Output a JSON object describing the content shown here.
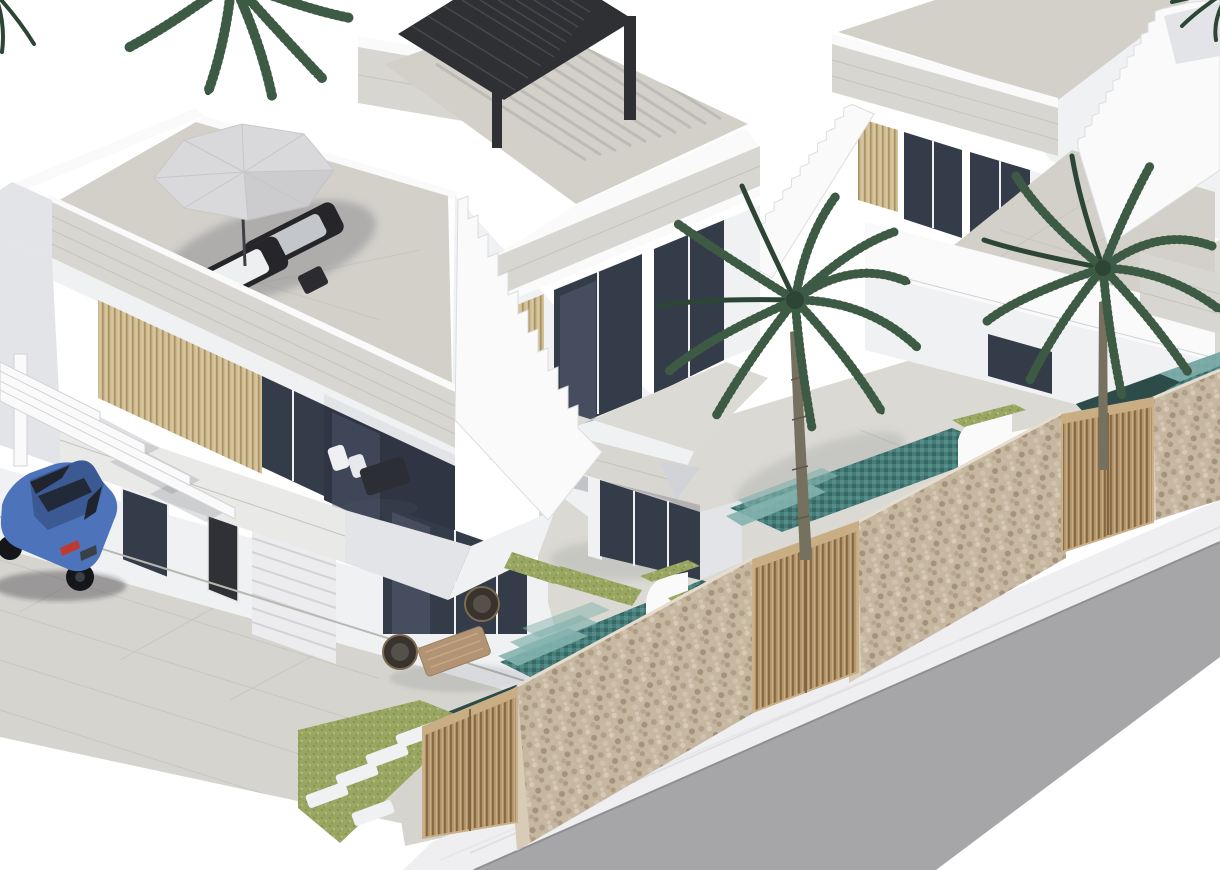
{
  "meta": {
    "type": "3d-architectural-render",
    "subject": "Isometric CGI rendering of a row of three modern white two-storey villas with roof terraces, private pools, palm trees, stone boundary walls with wooden gates, a parked blue car under a carport, and a street with sidewalk in the foreground",
    "canvas": {
      "width": 1220,
      "height": 870
    }
  },
  "colors": {
    "bg": "#ffffff",
    "w0": "#fafafb",
    "w1": "#f0f1f3",
    "w2": "#e3e4e8",
    "w3": "#d2d3d8",
    "w4": "#c2c3c9",
    "trav": "#d8d6d0",
    "travd": "#c6c4bd",
    "floor": "#d2d0c9",
    "floor2": "#dcdad4",
    "terr": "#dbd9d3",
    "drive": "#d6d4ce",
    "joint": "#c2c0ba",
    "glass": "#353c49",
    "glassm": "#58627a",
    "frame": "#eef0f2",
    "slata": "#cdbb94",
    "slatb": "#a18854",
    "gatea": "#b2946c",
    "gateb": "#86683f",
    "gatec": "#cbb088",
    "perg": "#2e3033",
    "pergl": "#45484d",
    "umb": "#d9d9db",
    "umbd": "#c6c6ca",
    "loungf": "#26262a",
    "loungc": "#edeff0",
    "wick": "#38332c",
    "wickl": "#7c6b50",
    "tablew": "#b29475",
    "grass": "#9aa763",
    "grassd": "#859450",
    "grassl": "#aeba78",
    "paver": "#dcd9cf",
    "poold": "#2c4b49",
    "poolm": "#447d7a",
    "pools": "#84b2ae",
    "poolp": "#b9cfd6",
    "stone": "#c6b7a1",
    "stonel": "#d8cbb8",
    "road": "#a6a6a9",
    "side": "#efeff1",
    "sidel": "#e0e0e3",
    "trunk": "#76705f",
    "palm1": "#2c4534",
    "palm2": "#3c5a44",
    "palm3": "#527458",
    "carb": "#4d74bb",
    "card": "#3b5a94",
    "carg": "#20242e",
    "wheel": "#141619",
    "tail": "#c0392e"
  },
  "scene": {
    "villas": [
      {
        "id": "villa-1",
        "position": "front-left",
        "features": [
          "roof terrace with octagonal grey parasol",
          "two sun loungers with white cushions",
          "side table",
          "travertine parapet band",
          "wood-slat cladding",
          "dark glazed windows",
          "first-floor balcony with two white chairs and dark table",
          "carport with white beams and post",
          "dark entrance door",
          "white ribbed garage door",
          "corner glass wall",
          "terrace with two round wicker chairs and wooden coffee table",
          "private pool with teal mosaic and steps",
          "lawn with stepping-stone pavers",
          "wooden slatted gate"
        ]
      },
      {
        "id": "villa-2",
        "position": "middle",
        "features": [
          "roof terrace with black aluminium slatted pergola",
          "pergola stripe shadows on tiled floor",
          "travertine roof fascia",
          "wood-slat strip",
          "two dark glass doors to balcony",
          "balcony terrace",
          "covered ground-floor terrace with glass wall",
          "palm tree in garden",
          "pool with teal mosaic steps",
          "white cascade water feature with planted top",
          "lawn strip",
          "wooden slatted gate"
        ]
      },
      {
        "id": "villa-3",
        "position": "back-right",
        "features": [
          "flat travertine roof slab",
          "wood-slat strip and dark windows",
          "upper terrace",
          "external staircase with white parapet",
          "second staircase at right edge",
          "dark ground-floor window",
          "pool with teal mosaic steps",
          "white cascade water feature",
          "lawn strip",
          "wooden slatted gate",
          "palm tree"
        ]
      }
    ],
    "shared_elements": [
      "continuous rubble stone boundary wall",
      "three wooden slatted gates",
      "white sidewalk",
      "grey asphalt road",
      "external stair between villa 2 and villa 3"
    ],
    "vegetation": {
      "palms_full": 2,
      "palms_partial_top": 3,
      "lawns": 5
    },
    "vehicle": {
      "type": "sedan car",
      "color_name": "blue",
      "location": "parked on driveway under carport, lower left"
    },
    "lighting": "bright daylight from upper left, soft shadows",
    "background": "pure white (cut-out style render)"
  }
}
